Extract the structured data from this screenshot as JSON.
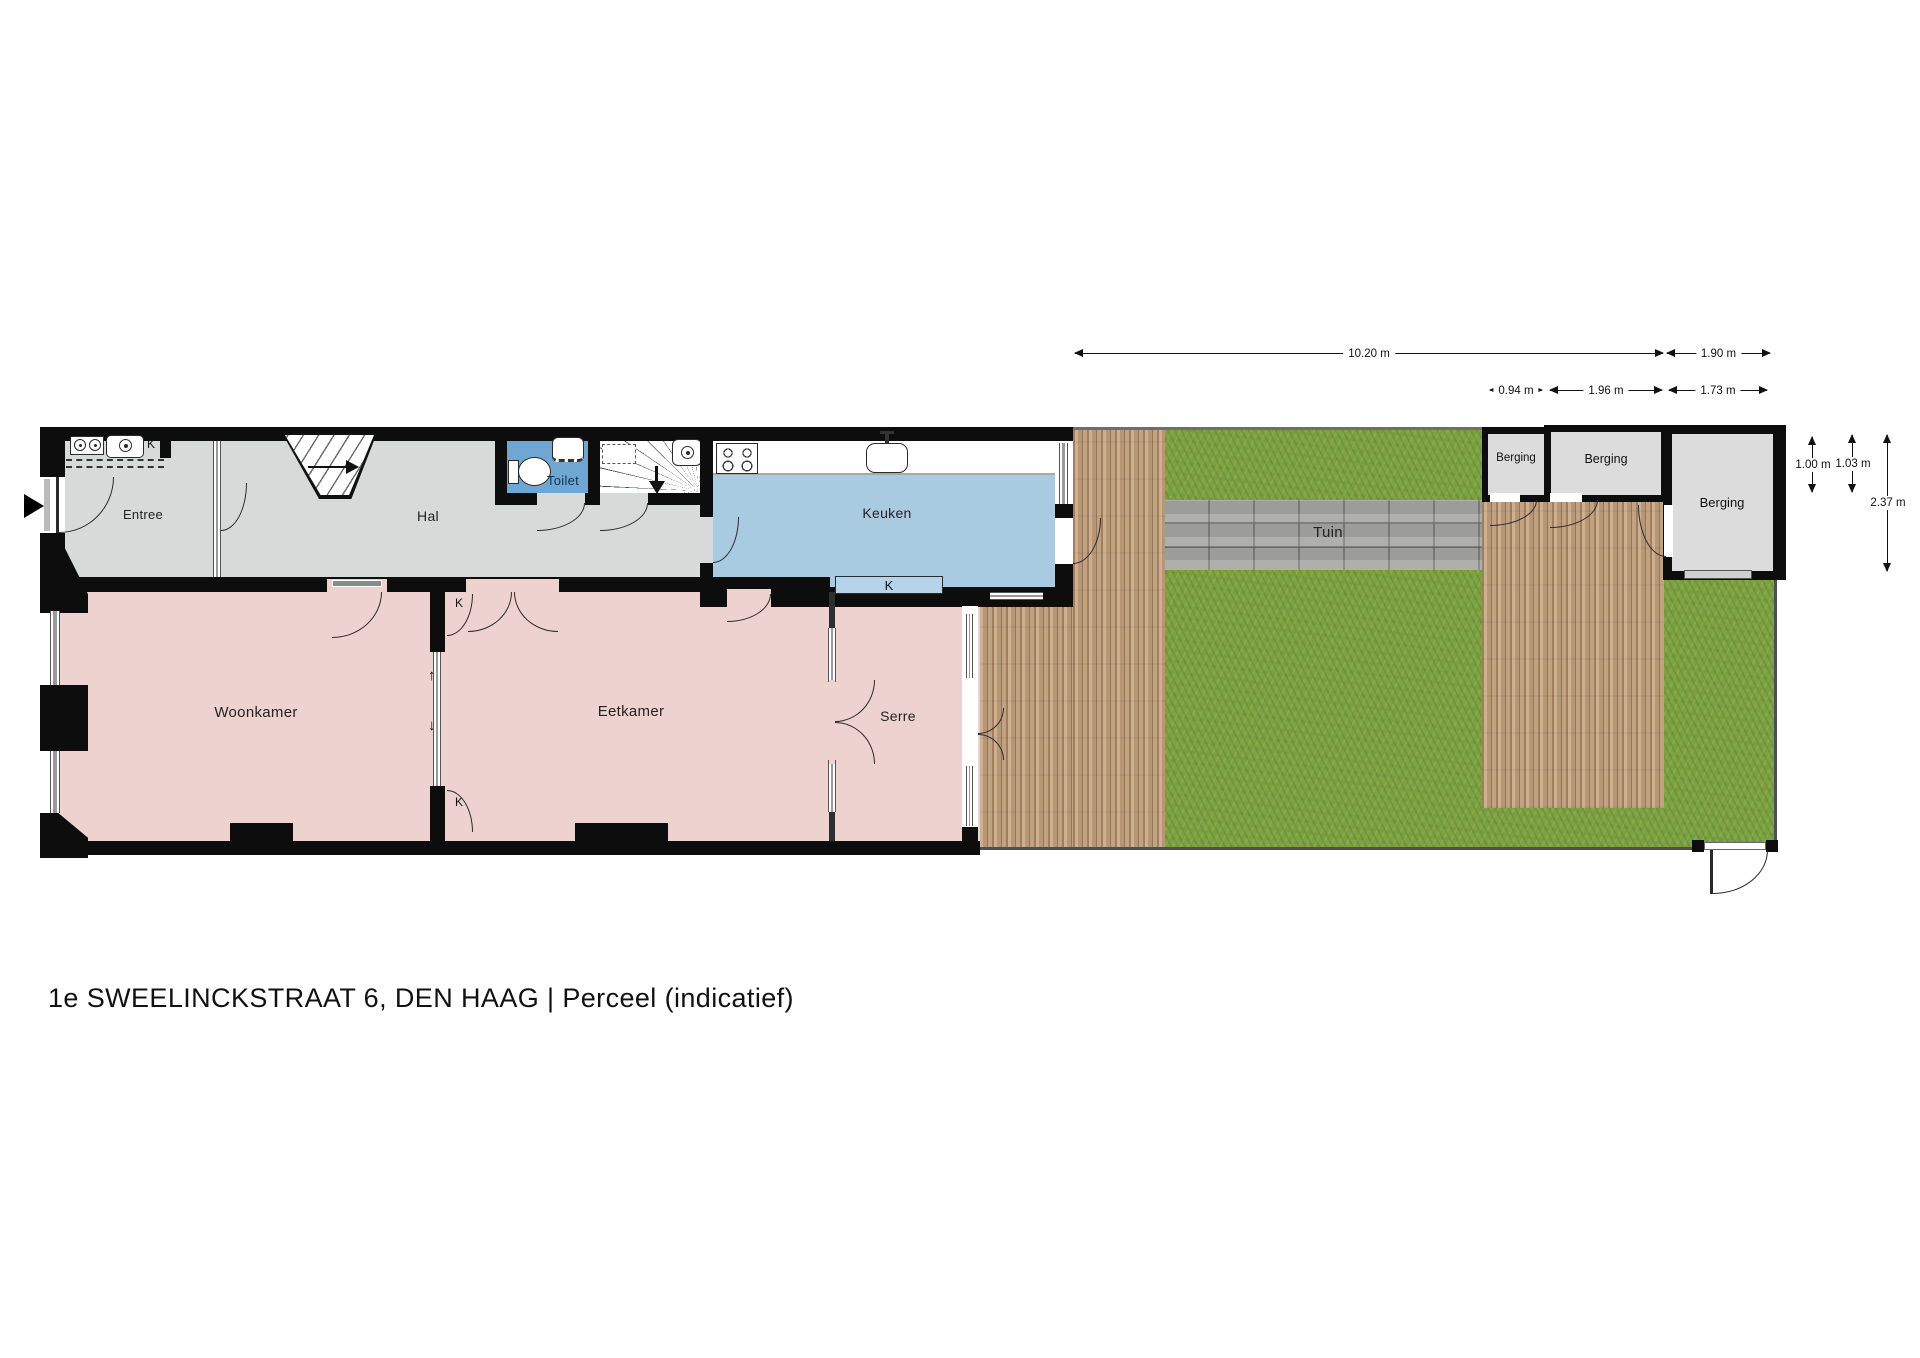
{
  "title": "1e SWEELINCKSTRAAT 6, DEN HAAG  | Perceel  (indicatief)",
  "rooms": {
    "entree": "Entree",
    "hal": "Hal",
    "toilet": "Toilet",
    "keuken": "Keuken",
    "woonkamer": "Woonkamer",
    "eetkamer": "Eetkamer",
    "serre": "Serre",
    "tuin": "Tuin",
    "berging_small": "Berging",
    "berging_mid": "Berging",
    "berging_large": "Berging"
  },
  "cupboards": {
    "entree_k": "K",
    "keuken_k": "K",
    "ensuite_k_top": "K",
    "ensuite_k_bottom": "K"
  },
  "glyphs": {
    "slide_up": "↑",
    "slide_down": "↓"
  },
  "dimensions": {
    "top": [
      {
        "label": "10.20 m"
      },
      {
        "label": "1.90 m"
      }
    ],
    "sheds": [
      {
        "label": "0.94 m"
      },
      {
        "label": "1.96 m"
      },
      {
        "label": "1.73 m"
      }
    ],
    "right": [
      {
        "label": "1.00 m"
      },
      {
        "label": "1.03 m"
      },
      {
        "label": "2.37 m"
      }
    ]
  },
  "colors": {
    "wall": "#0d0d0d",
    "hall_floor": "#d7dad8",
    "living_floor": "#eed2cf",
    "kitchen_floor": "#a9cbe2",
    "toilet_floor": "#6fa7d2",
    "cupboard_fill": "#b5d4e9",
    "shed_floor": "#dcdcdc",
    "grass": "#7ba342",
    "deck": "#b79878",
    "path": "#a6a6a4"
  }
}
